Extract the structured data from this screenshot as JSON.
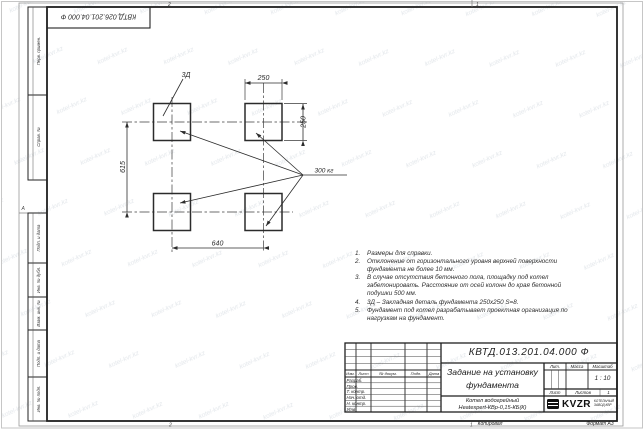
{
  "watermark": {
    "text": "kotel-kvr.kz"
  },
  "stamp_top": {
    "designation": "КВТД.026.201.04.000 Ф"
  },
  "frame": {
    "zone_marks": {
      "top_left": "2",
      "top_right": "1",
      "bottom_left": "2",
      "bottom_right": "1",
      "left": "А"
    },
    "strips": [
      {
        "label": "Перв. примен."
      },
      {
        "label": "Справ. №"
      },
      {
        "label": "Подп. и дата"
      },
      {
        "label": "Инв. № дубл."
      },
      {
        "label": "Взам. инв. №"
      },
      {
        "label": "Подп. и дата"
      },
      {
        "label": "Инв. № подл."
      }
    ]
  },
  "drawing": {
    "dim_width_top": "250",
    "dim_height_right": "250",
    "dim_left": "615",
    "dim_bottom": "640",
    "embed_label": "3Д",
    "load_label": "300 кг"
  },
  "notes": {
    "items": [
      {
        "num": "1.",
        "text": "Размеры для справки."
      },
      {
        "num": "2.",
        "text": "Отклонение от горизонтального уровня верхней поверхности фундамента не более 10 мм."
      },
      {
        "num": "3.",
        "text": "В случае отсутствия бетонного пола, площадку под котел забетонировать. Расстояние от осей колонн до края бетонной подушки 500 мм."
      },
      {
        "num": "4.",
        "text": "3Д – Закладная деталь фундамента 250х250 S=8."
      },
      {
        "num": "5.",
        "text": "Фундамент под котел разрабатывает проектная организация по нагрузкам на фундамент."
      }
    ]
  },
  "title_block": {
    "designation": "КВТД.013.201.04.000 Ф",
    "title_line1": "Задание на установку",
    "title_line2": "фундамента",
    "product_line1": "Котел водогрейный",
    "product_line2": "Heatexpert-КВр-0,15-КБ(К)",
    "col_izm": "Изм.",
    "col_list": "Лист",
    "col_doc": "№ докум.",
    "col_sign": "Подп.",
    "col_date": "Дата",
    "rows": [
      {
        "label": "Разраб."
      },
      {
        "label": "Пров."
      },
      {
        "label": "Т. контр."
      },
      {
        "label": "Нач. отд."
      },
      {
        "label": "Н. контр."
      },
      {
        "label": "Утв."
      }
    ],
    "lit_header": "Лит.",
    "mass_header": "Масса",
    "scale_header": "Масштаб",
    "scale_value": "1 : 10",
    "sheet_label": "Лист",
    "sheets_label": "Листов",
    "sheets_value": "1",
    "logo": {
      "text": "KVZR",
      "sub_line1": "КОТЕЛЬНЫЙ",
      "sub_line2": "ЗАВОД КВР"
    },
    "footer": {
      "copied": "Копировал",
      "format": "Формат А3"
    }
  }
}
